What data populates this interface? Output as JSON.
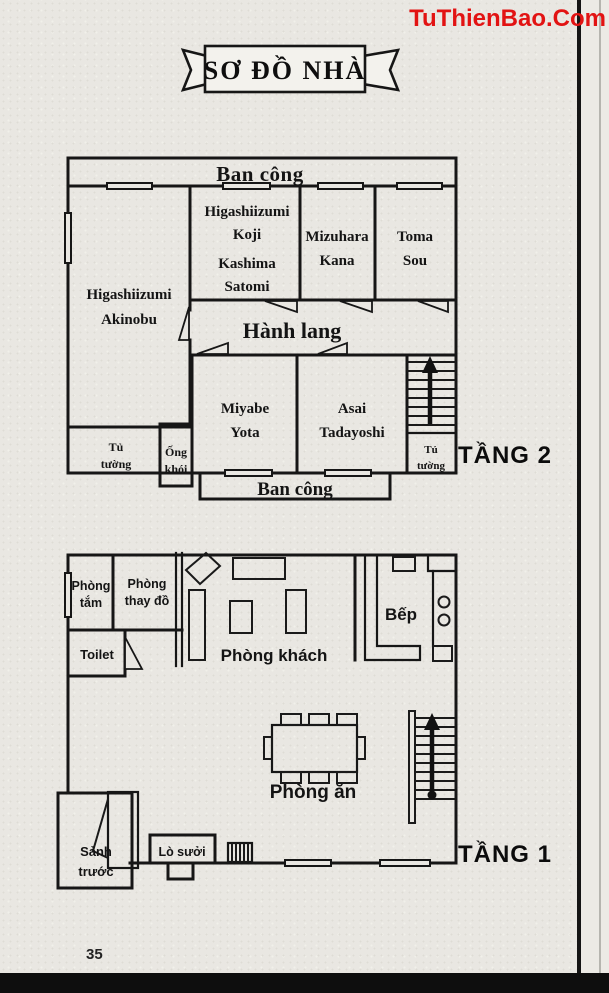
{
  "watermark": {
    "text": "TuThienBao.Com",
    "color": "#e21313"
  },
  "page": {
    "title": "SƠ ĐỒ NHÀ",
    "number": "35"
  },
  "colors": {
    "ink": "#161616",
    "paper": "#e9e7e2",
    "watermark_red": "#e21313"
  },
  "floor2": {
    "label": "TẦNG 2",
    "balcony_top": "Ban công",
    "balcony_bottom": "Ban công",
    "hallway": "Hành lang",
    "rooms": {
      "akinobu": {
        "line1": "Higashiizumi",
        "line2": "Akinobu"
      },
      "koji": {
        "line1": "Higashiizumi",
        "line2": "Koji",
        "line3": "Kashima",
        "line4": "Satomi"
      },
      "mizuhara": {
        "line1": "Mizuhara",
        "line2": "Kana"
      },
      "toma": {
        "line1": "Toma",
        "line2": "Sou"
      },
      "miyabe": {
        "line1": "Miyabe",
        "line2": "Yota"
      },
      "asai": {
        "line1": "Asai",
        "line2": "Tadayoshi"
      },
      "closet_left": {
        "line1": "Tủ",
        "line2": "tường"
      },
      "chimney": {
        "line1": "Ống",
        "line2": "khói"
      },
      "closet_right": {
        "line1": "Tủ",
        "line2": "tường"
      }
    }
  },
  "floor1": {
    "label": "TẦNG 1",
    "rooms": {
      "bathroom": {
        "line1": "Phòng",
        "line2": "tắm"
      },
      "changing": {
        "line1": "Phòng",
        "line2": "thay đồ"
      },
      "toilet": "Toilet",
      "living": "Phòng khách",
      "kitchen": "Bếp",
      "dining": "Phòng ăn",
      "porch": {
        "line1": "Sảnh",
        "line2": "trước"
      },
      "fireplace": "Lò sưởi"
    }
  }
}
